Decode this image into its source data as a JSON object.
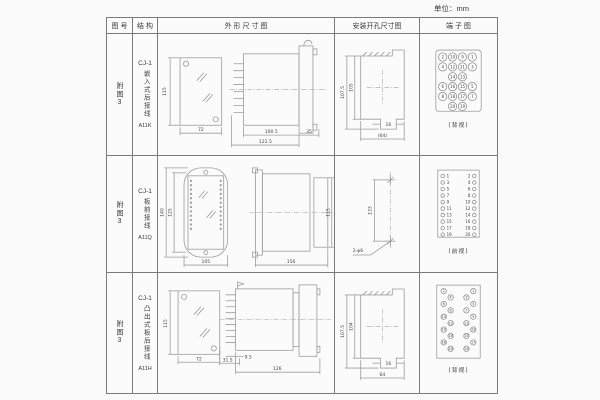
{
  "page": {
    "unit": "单位：mm"
  },
  "table": {
    "headers": [
      "图 号",
      "结 构",
      "外 形 尺 寸 图",
      "安装开孔尺寸图",
      "端 子 图"
    ],
    "rows": [
      {
        "figure": "附图3",
        "model": "CJ-1",
        "structure": "嵌入式后接线",
        "code": "A11K",
        "outline": {
          "front_h": "115",
          "front_w": "72",
          "body_len": "100.5",
          "total_len": "122.5",
          "flange": "35"
        },
        "mounting": {
          "outer_h": "107.5",
          "inner_h": "105",
          "slot_w": "16",
          "width": "(64)"
        },
        "terminal": {
          "view": "(背视)",
          "rows": [
            [
              "2",
              "10",
              "9",
              "1"
            ],
            [
              "4",
              "12",
              "11",
              "3"
            ],
            [
              "14",
              "13"
            ],
            [
              "6",
              "16",
              "15",
              "5"
            ],
            [
              "8",
              "18",
              "17",
              "7"
            ],
            [
              "20",
              "19"
            ]
          ]
        }
      },
      {
        "figure": "附图3",
        "model": "CJ-1",
        "structure": "板前接线",
        "code": "A11Q",
        "outline": {
          "front_outer_h": "140",
          "front_inner_h": "125",
          "front_w": "105",
          "side_len": "156",
          "side_h": "115"
        },
        "mounting": {
          "hole_dist": "133",
          "holes": "2-φ6"
        },
        "terminal": {
          "view": "(前视)",
          "left": [
            "1",
            "3",
            "5",
            "7",
            "9",
            "11",
            "13",
            "15",
            "17",
            "19"
          ],
          "right": [
            "2",
            "4",
            "6",
            "8",
            "10",
            "12",
            "14",
            "16",
            "18",
            "20"
          ]
        }
      },
      {
        "figure": "附图3",
        "model": "CJ-1",
        "structure": "凸出式板后接线",
        "code": "A11H",
        "outline": {
          "front_h": "115",
          "front_w": "72",
          "pin_len": "9.5",
          "back_len": "31.5",
          "body_len": "126"
        },
        "mounting": {
          "outer_h": "107.5",
          "inner_h": "104",
          "slot_w": "16",
          "width": "64"
        },
        "terminal": {
          "view": "(背视)",
          "left_outer": [
            "2",
            "6",
            "10",
            "14",
            "18"
          ],
          "left_inner": [
            "4",
            "8",
            "12",
            "16",
            "20"
          ],
          "right_inner": [
            "3",
            "7",
            "11",
            "15",
            "19"
          ],
          "right_outer": [
            "1",
            "5",
            "9",
            "13",
            "17"
          ]
        }
      }
    ]
  }
}
